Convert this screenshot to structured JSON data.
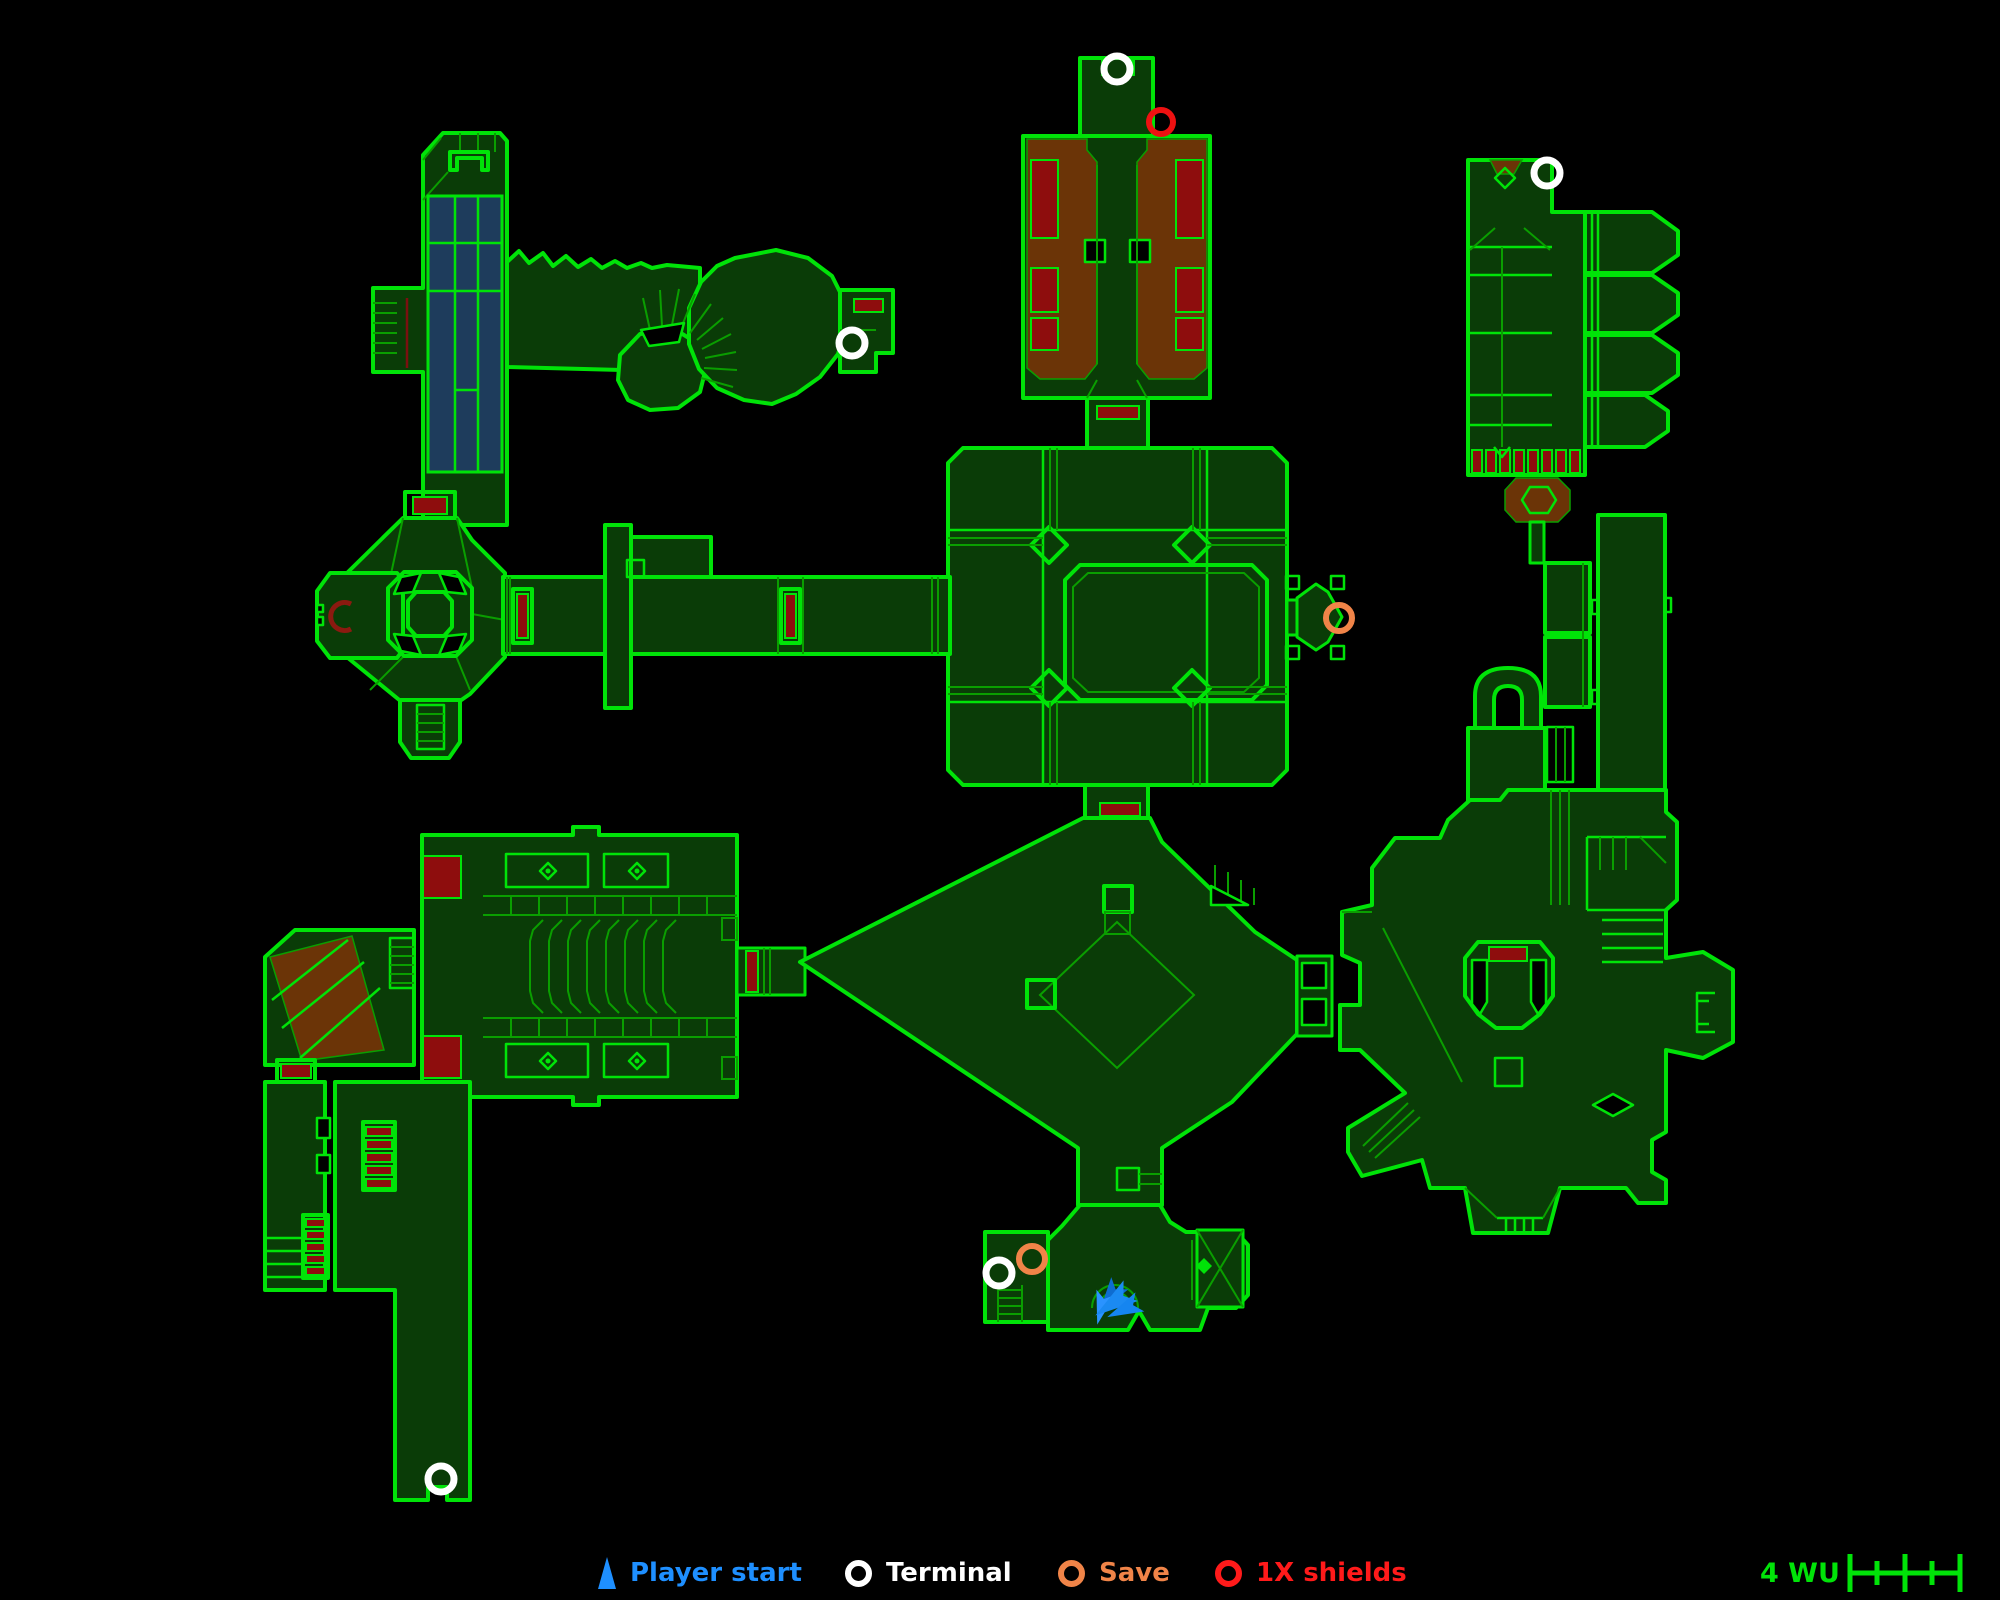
{
  "legend": {
    "items": [
      {
        "id": "player-start",
        "label": "Player start",
        "color": "#1e8fff",
        "marker": "arrow"
      },
      {
        "id": "terminal",
        "label": "Terminal",
        "color": "#ffffff",
        "marker": "ring"
      },
      {
        "id": "save",
        "label": "Save",
        "color": "#f08448",
        "marker": "ring"
      },
      {
        "id": "shields",
        "label": "1X shields",
        "color": "#ff1a1a",
        "marker": "ring"
      }
    ]
  },
  "scale_bar": {
    "label": "4 WU",
    "units": 4,
    "color": "#00e308"
  },
  "map": {
    "background": "#000000",
    "wall_color": "#00e308",
    "detail_color": "#0a9e00",
    "floor_color": "#0a3c07",
    "water_color": "#1e3c5c",
    "lava_color": "#6b3407",
    "hazard_color": "#8e0d0d",
    "marker_styles": {
      "terminal": {
        "shape": "ring",
        "color": "#ffffff",
        "radius": 13,
        "stroke": 7
      },
      "save": {
        "shape": "ring",
        "color": "#f08448",
        "radius": 13,
        "stroke": 6
      },
      "shields": {
        "shape": "ring",
        "color": "#ee1111",
        "radius": 12,
        "stroke": 6
      },
      "player-start": {
        "shape": "arrow",
        "color": "#1b8af2"
      }
    },
    "markers": [
      {
        "type": "terminal",
        "x": 1117,
        "y": 69
      },
      {
        "type": "shields",
        "x": 1161,
        "y": 122
      },
      {
        "type": "terminal",
        "x": 1547,
        "y": 173
      },
      {
        "type": "terminal",
        "x": 852,
        "y": 343
      },
      {
        "type": "save",
        "x": 1339,
        "y": 618
      },
      {
        "type": "save",
        "x": 1032,
        "y": 1259
      },
      {
        "type": "terminal",
        "x": 999,
        "y": 1273
      },
      {
        "type": "terminal",
        "x": 441,
        "y": 1479
      },
      {
        "type": "player-start",
        "x": 1113,
        "y": 1293
      }
    ]
  }
}
